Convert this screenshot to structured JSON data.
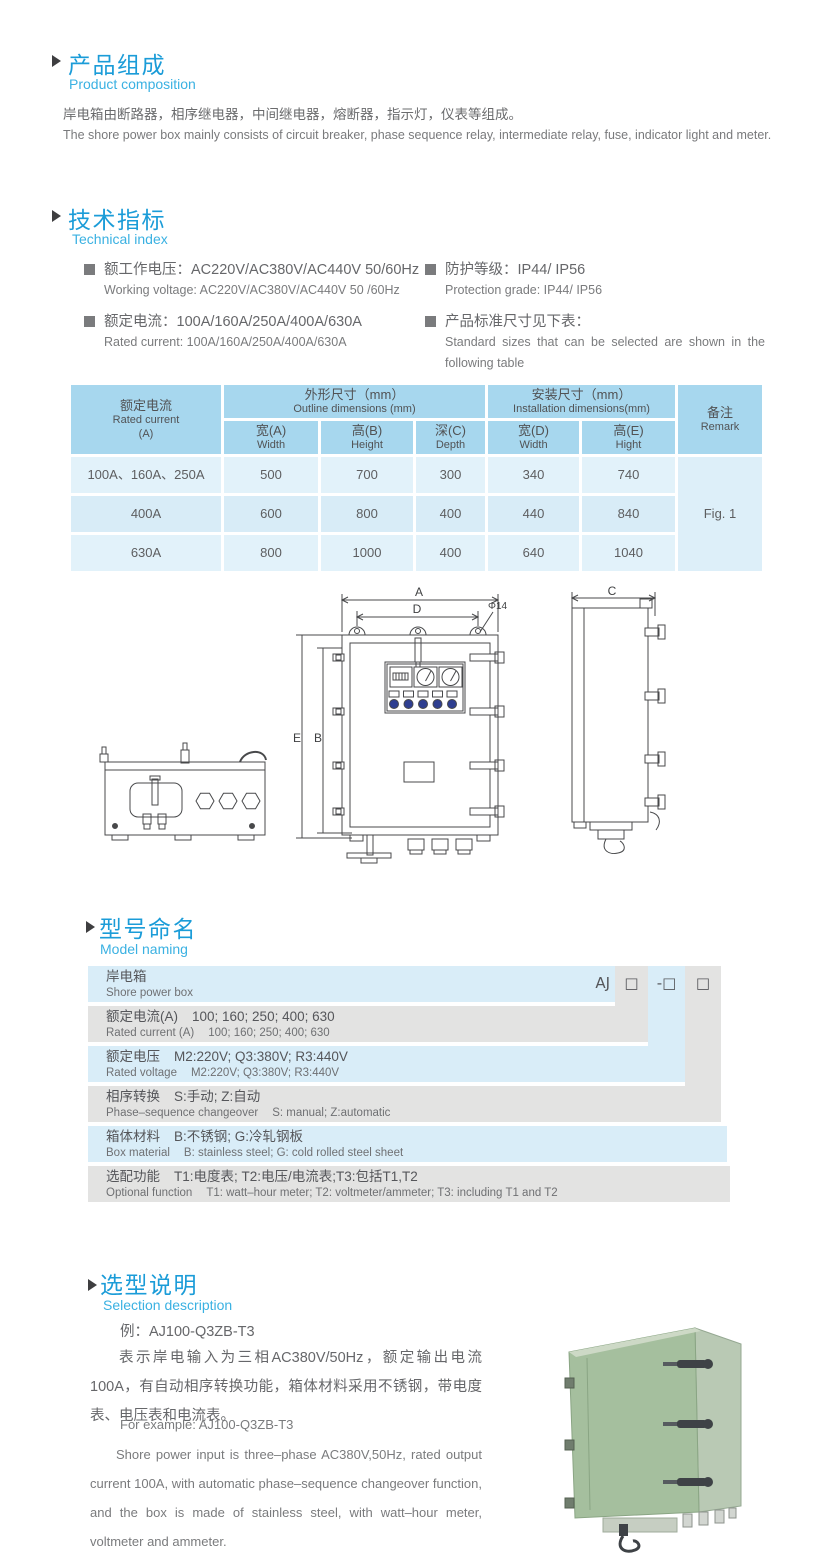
{
  "page": {
    "width": 830,
    "height": 1568
  },
  "colors": {
    "accent": "#1b9cd8",
    "accent_light": "#3ab1e2",
    "table_header": "#a7d7ee",
    "table_row": "#e2f2fa",
    "table_row_alt": "#d8ecf7",
    "band_blue": "#d9edf8",
    "band_gray": "#e3e3e2",
    "text_gray": "#6a6b6d",
    "text_dark": "#55565a",
    "photo_green": "#a5bf9e"
  },
  "composition": {
    "title_zh": "产品组成",
    "title_en": "Product  composition",
    "body_zh": "岸电箱由断路器，相序继电器，中间继电器，熔断器，指示灯，仪表等组成。",
    "body_en": "The shore power box mainly consists of circuit breaker, phase sequence relay, intermediate relay, fuse, indicator light and meter."
  },
  "technical": {
    "title_zh": "技术指标",
    "title_en": "Technical index",
    "working_voltage_zh": "额工作电压：AC220V/AC380V/AC440V  50/60Hz",
    "working_voltage_en": "Working voltage: AC220V/AC380V/AC440V 50 /60Hz",
    "rated_current_zh": "额定电流：100A/160A/250A/400A/630A",
    "rated_current_en": "Rated current: 100A/160A/250A/400A/630A",
    "protection_zh": "防护等级：IP44/ IP56",
    "protection_en": "Protection grade: IP44/ IP56",
    "sizes_zh": "产品标准尺寸见下表：",
    "sizes_en": "Standard  sizes  that  can  be  selected  are  shown  in  the following table"
  },
  "table": {
    "col_current_zh": "额定电流",
    "col_current_en": "Rated current",
    "col_current_unit": "(A)",
    "group_outline_zh": "外形尺寸（mm）",
    "group_outline_en": "Outline dimensions (mm)",
    "group_install_zh": "安装尺寸（mm）",
    "group_install_en": "Installation dimensions(mm)",
    "col_remark_zh": "备注",
    "col_remark_en": "Remark",
    "sub_headers": [
      {
        "zh": "宽(A)",
        "en": "Width"
      },
      {
        "zh": "高(B)",
        "en": "Height"
      },
      {
        "zh": "深(C)",
        "en": "Depth"
      },
      {
        "zh": "宽(D)",
        "en": "Width"
      },
      {
        "zh": "高(E)",
        "en": "Hight"
      }
    ],
    "rows": [
      {
        "current": "100A、160A、250A",
        "w": "500",
        "h": "700",
        "d": "300",
        "iw": "340",
        "ih": "740"
      },
      {
        "current": "400A",
        "w": "600",
        "h": "800",
        "d": "400",
        "iw": "440",
        "ih": "840"
      },
      {
        "current": "630A",
        "w": "800",
        "h": "1000",
        "d": "400",
        "iw": "640",
        "ih": "1040"
      }
    ],
    "remark_value": "Fig. 1"
  },
  "diagram": {
    "labels": {
      "a": "A",
      "d": "D",
      "phi": "Φ14",
      "e": "E",
      "b": "B",
      "c": "C"
    }
  },
  "model": {
    "title_zh": "型号命名",
    "title_en": "Model naming",
    "code": {
      "prefix": "AJ",
      "box1": "□",
      "box2": "-□",
      "box3": "□"
    },
    "rows": [
      {
        "label_zh": "岸电箱",
        "value_zh": "",
        "label_en": "Shore power box",
        "value_en": ""
      },
      {
        "label_zh": "额定电流(A)",
        "value_zh": "100; 160; 250; 400; 630",
        "label_en": "Rated current (A)",
        "value_en": "100; 160; 250; 400; 630"
      },
      {
        "label_zh": "额定电压",
        "value_zh": "M2:220V;  Q3:380V;  R3:440V",
        "label_en": "Rated voltage",
        "value_en": "M2:220V;  Q3:380V;  R3:440V"
      },
      {
        "label_zh": "相序转换",
        "value_zh": "S:手动; Z:自动",
        "label_en": "Phase–sequence changeover",
        "value_en": "S: manual;  Z:automatic"
      },
      {
        "label_zh": "箱体材料",
        "value_zh": "B:不锈钢;  G:冷轧钢板",
        "label_en": "Box material",
        "value_en": "B: stainless steel; G: cold rolled steel sheet"
      },
      {
        "label_zh": "选配功能",
        "value_zh": "T1:电度表;  T2:电压/电流表;T3:包括T1,T2",
        "label_en": "Optional function",
        "value_en": "T1: watt–hour meter; T2: voltmeter/ammeter; T3: including T1 and T2"
      }
    ]
  },
  "selection": {
    "title_zh": "选型说明",
    "title_en": "Selection description",
    "example_zh": "例：AJ100-Q3ZB-T3",
    "para_zh": "表示岸电输入为三相AC380V/50Hz，额定输出电流100A，有自动相序转换功能，箱体材料采用不锈钢，带电度表、电压表和电流表。",
    "example_en": "For example: AJ100-Q3ZB-T3",
    "para_en": "Shore power input is three–phase AC380V,50Hz, rated output current 100A, with automatic phase–sequence changeover function, and the box is made of stainless steel, with watt–hour meter, voltmeter and ammeter."
  }
}
